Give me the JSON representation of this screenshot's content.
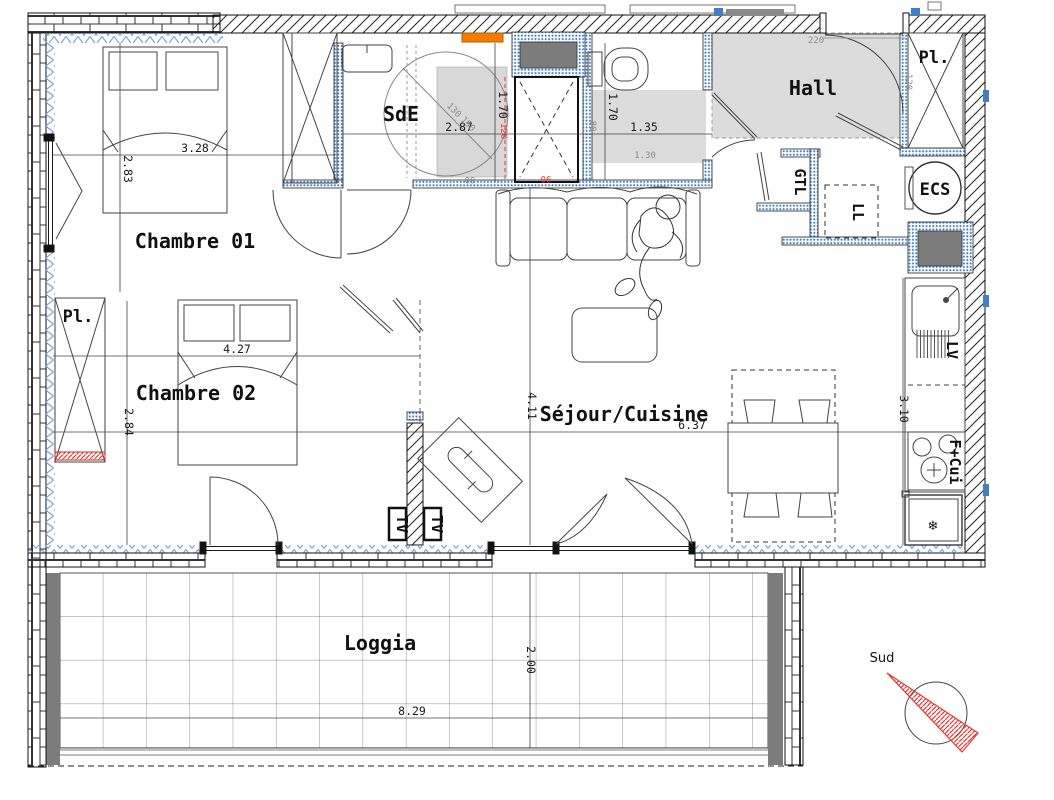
{
  "rooms": {
    "chambre1": {
      "label": "Chambre 01",
      "width": "3.28",
      "height": "2.83"
    },
    "chambre2": {
      "label": "Chambre 02",
      "width": "4.27",
      "height": "2.84"
    },
    "sde": {
      "label": "SdE",
      "width": "2.87",
      "height": "1.70"
    },
    "wc": {
      "width": "1.35",
      "height": "1.70",
      "depth": "1.30",
      "side": "80"
    },
    "hall": {
      "label": "Hall",
      "door_width": "220",
      "clearance": "120"
    },
    "sejour": {
      "label": "Séjour/Cuisine",
      "width": "6.37",
      "height": "4.11"
    },
    "cuisine": {
      "height": "3.10"
    },
    "loggia": {
      "label": "Loggia",
      "width": "8.29",
      "depth": "2.00"
    }
  },
  "closets": {
    "pl_chambre2": "Pl.",
    "pl_entree": "Pl."
  },
  "equipment": {
    "ecs": "ECS",
    "gtl": "GTL",
    "lave_linge": "LL",
    "lave_vaisselle": "LV",
    "four_cuisson": "F+Cui",
    "tv_left": "TV",
    "tv_right": "TV",
    "fridge_icon": "❄"
  },
  "annotations": {
    "sde_diag_1": "130",
    "sde_diag_2": "150",
    "sde_bottom": "60",
    "shower_width": "90",
    "shower_clearance": "120"
  },
  "compass": {
    "label": "Sud"
  },
  "colors": {
    "insulation_blue": "#6f9fd8",
    "partition_blue": "#3f7fc4",
    "room_gray": "#dcdcdc",
    "dark_gray": "#7c7c7c",
    "accent_orange": "#f57c00",
    "alert_red": "#e53935",
    "dim_gray": "#8a8a8a"
  }
}
